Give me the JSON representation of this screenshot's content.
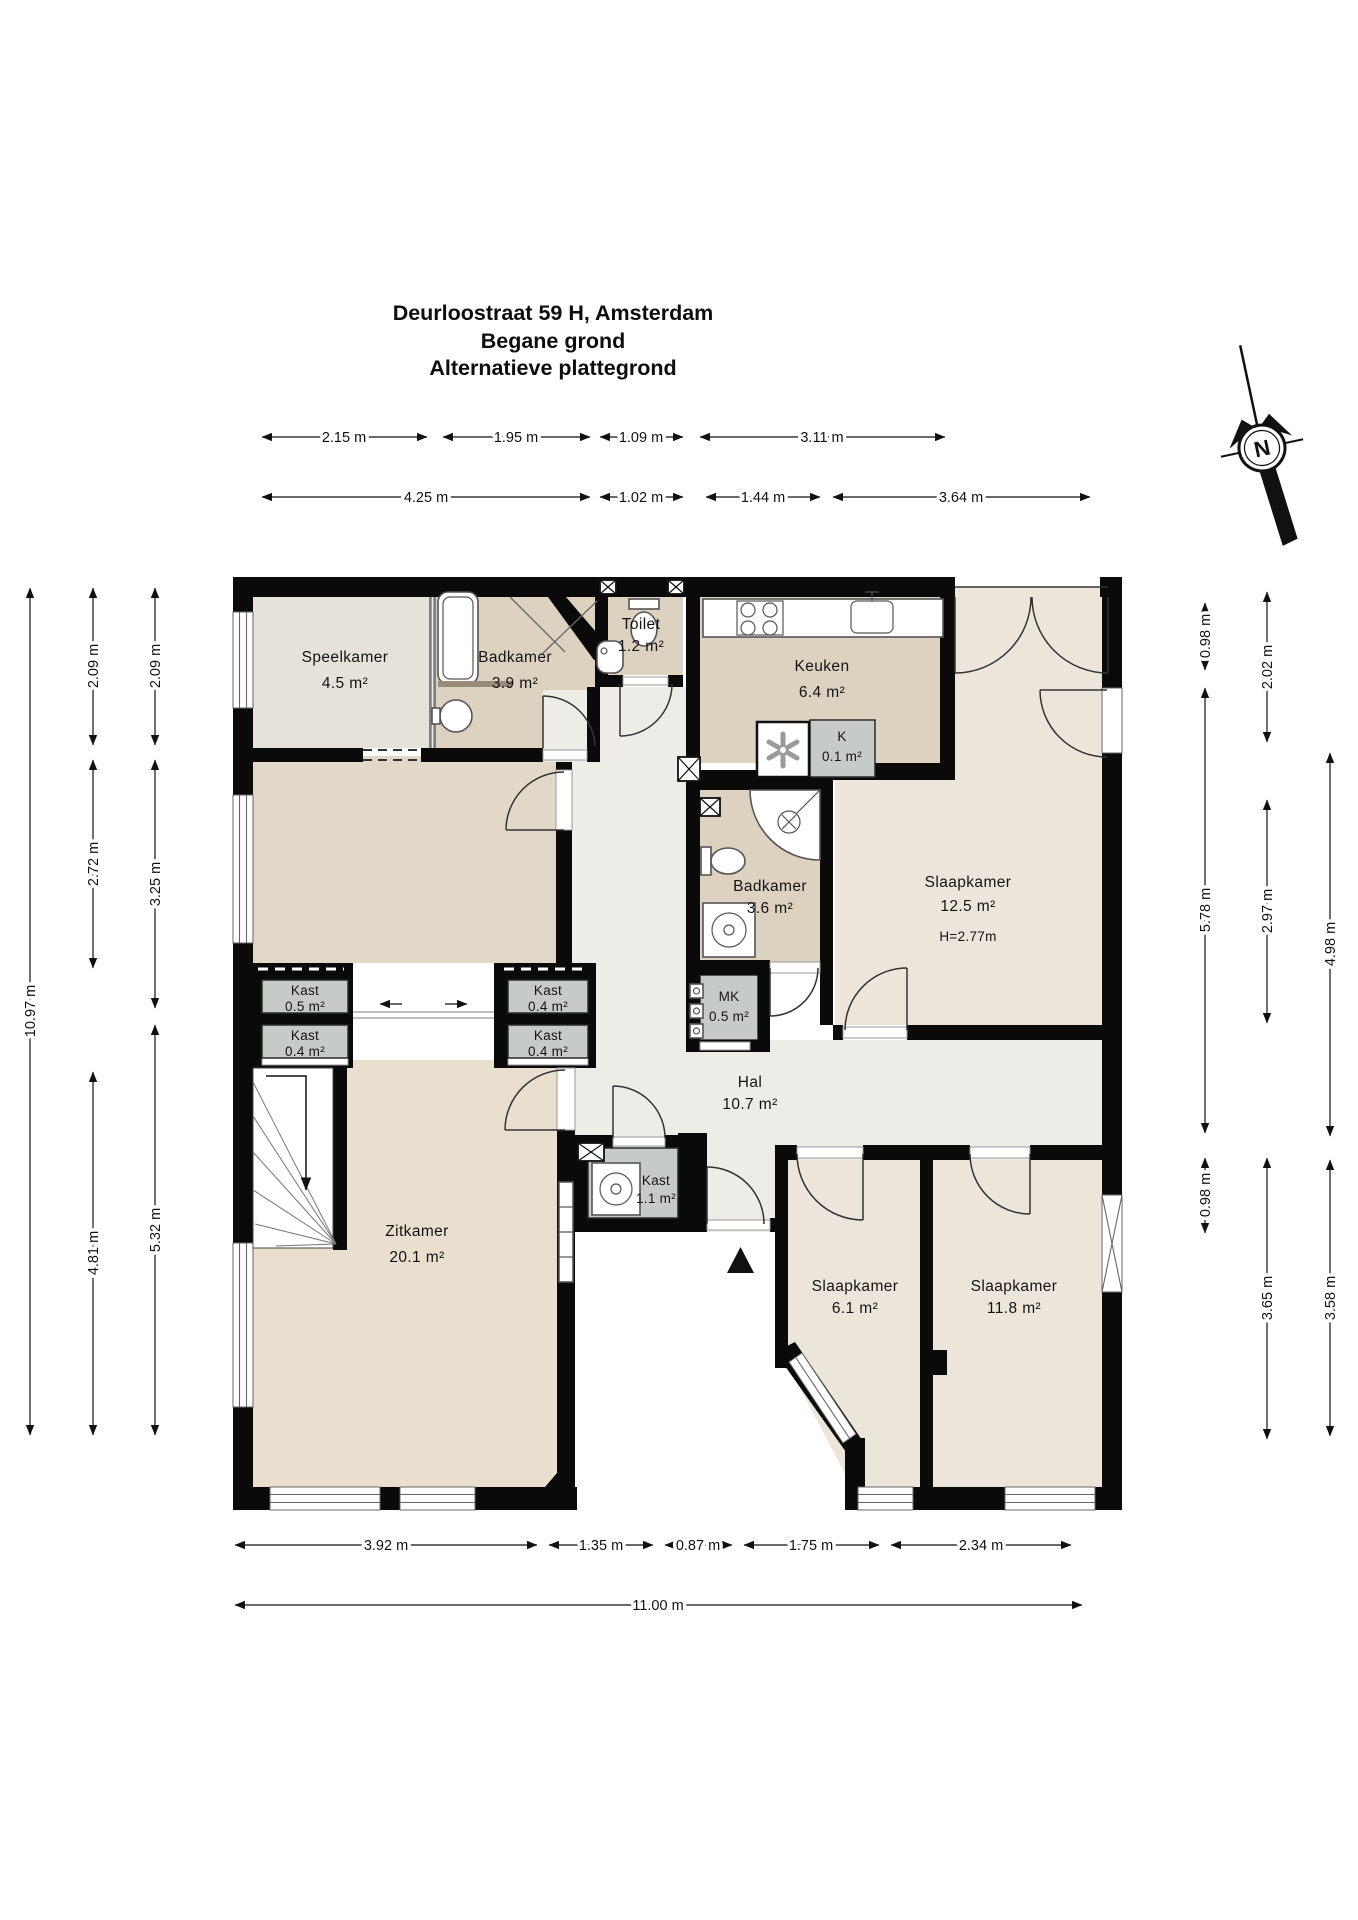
{
  "title": {
    "line1": "Deurloostraat 59 H, Amsterdam",
    "line2": "Begane grond",
    "line3": "Alternatieve plattegrond"
  },
  "compass": {
    "label": "N"
  },
  "rooms": [
    {
      "name": "Speelkamer",
      "area": "4.5 m²"
    },
    {
      "name": "Badkamer",
      "area": "3.9 m²"
    },
    {
      "name": "Toilet",
      "area": "1.2 m²"
    },
    {
      "name": "Keuken",
      "area": "6.4 m²"
    },
    {
      "name": "K",
      "area": "0.1 m²"
    },
    {
      "name": "Slaapkamer",
      "area": "12.5 m²",
      "note": "H=2.77m"
    },
    {
      "name": "Badkamer",
      "area": "3.6 m²"
    },
    {
      "name": "MK",
      "area": "0.5 m²"
    },
    {
      "name": "Hal",
      "area": "10.7 m²"
    },
    {
      "name": "Kast",
      "area": "0.5 m²"
    },
    {
      "name": "Kast",
      "area": "0.4 m²"
    },
    {
      "name": "Kast",
      "area": "0.4 m²"
    },
    {
      "name": "Kast",
      "area": "0.4 m²"
    },
    {
      "name": "Kast",
      "area": "1.1 m²"
    },
    {
      "name": "Zitkamer",
      "area": "20.1 m²"
    },
    {
      "name": "Slaapkamer",
      "area": "6.1 m²"
    },
    {
      "name": "Slaapkamer",
      "area": "11.8 m²"
    }
  ],
  "dimensions": {
    "top_inner": [
      "2.15 m",
      "1.95 m",
      "1.09 m",
      "3.11 m"
    ],
    "top_outer": [
      "4.25 m",
      "1.02 m",
      "1.44 m",
      "3.64 m"
    ],
    "left_outer": "10.97 m",
    "left_mid": [
      "2.09 m",
      "2.72 m",
      "4.81 m"
    ],
    "left_inner": [
      "2.09 m",
      "3.25 m",
      "5.32 m"
    ],
    "right_inner": [
      "0.98 m",
      "5.78 m",
      "0.98 m"
    ],
    "right_mid": [
      "2.02 m",
      "2.97 m",
      "3.65 m"
    ],
    "right_outer": [
      "4.98 m",
      "3.58 m"
    ],
    "bottom_inner": [
      "3.92 m",
      "1.35 m",
      "0.87 m",
      "1.75 m",
      "2.34 m"
    ],
    "bottom_outer": "11.00 m"
  },
  "colors": {
    "wall": "#0a0a0a",
    "floor_beige": "#ddd2c0",
    "floor_cream": "#ebe6d9",
    "floor_speelkamer": "#e6e2d9",
    "floor_eetkamer": "#e2d8c7",
    "floor_zitkamer": "#e8dfcf",
    "floor_hal": "#edece6",
    "closet_gray": "#c7cbc7",
    "radiator": "#9a8a78"
  }
}
